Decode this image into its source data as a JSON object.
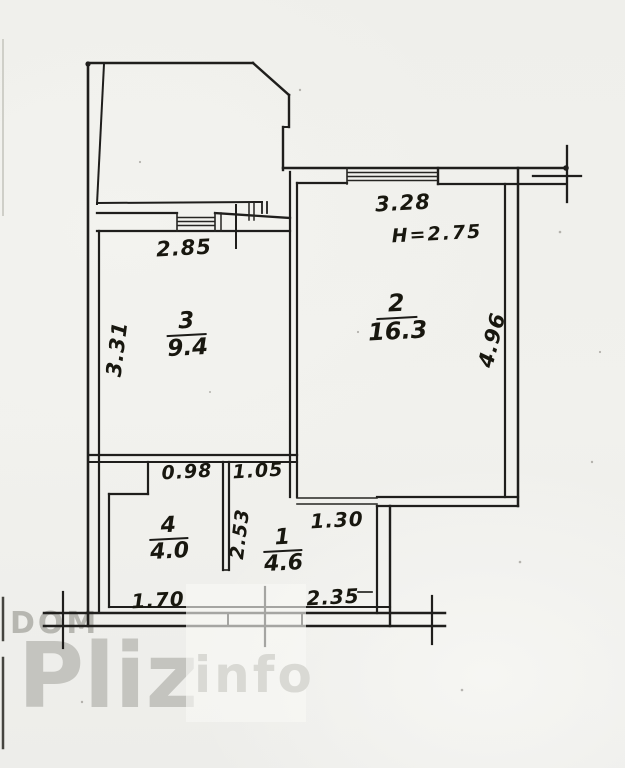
{
  "plan": {
    "title": "apartment floor plan (scanned, hand-drawn)",
    "rooms": [
      {
        "number": "1",
        "area": "4.6"
      },
      {
        "number": "2",
        "area": "16.3"
      },
      {
        "number": "3",
        "area": "9.4"
      },
      {
        "number": "4",
        "area": "4.0"
      }
    ],
    "dimensions": {
      "room3_width": "2.85",
      "room3_depth": "3.31",
      "room2_width": "3.28",
      "room2_height": "H=2.75",
      "room2_depth": "4.96",
      "room4_top": "0.98",
      "room4_bottom": "1.70",
      "room1_top": "1.05",
      "room1_side": "2.53",
      "room1_niche": "1.30",
      "room1_bottom": "2.35"
    },
    "colors": {
      "ink": "#1f1e1c",
      "paper": "#f1f1ed"
    }
  },
  "watermark": {
    "dom": "DOM",
    "pliz": "Pliz",
    "info": "info"
  }
}
